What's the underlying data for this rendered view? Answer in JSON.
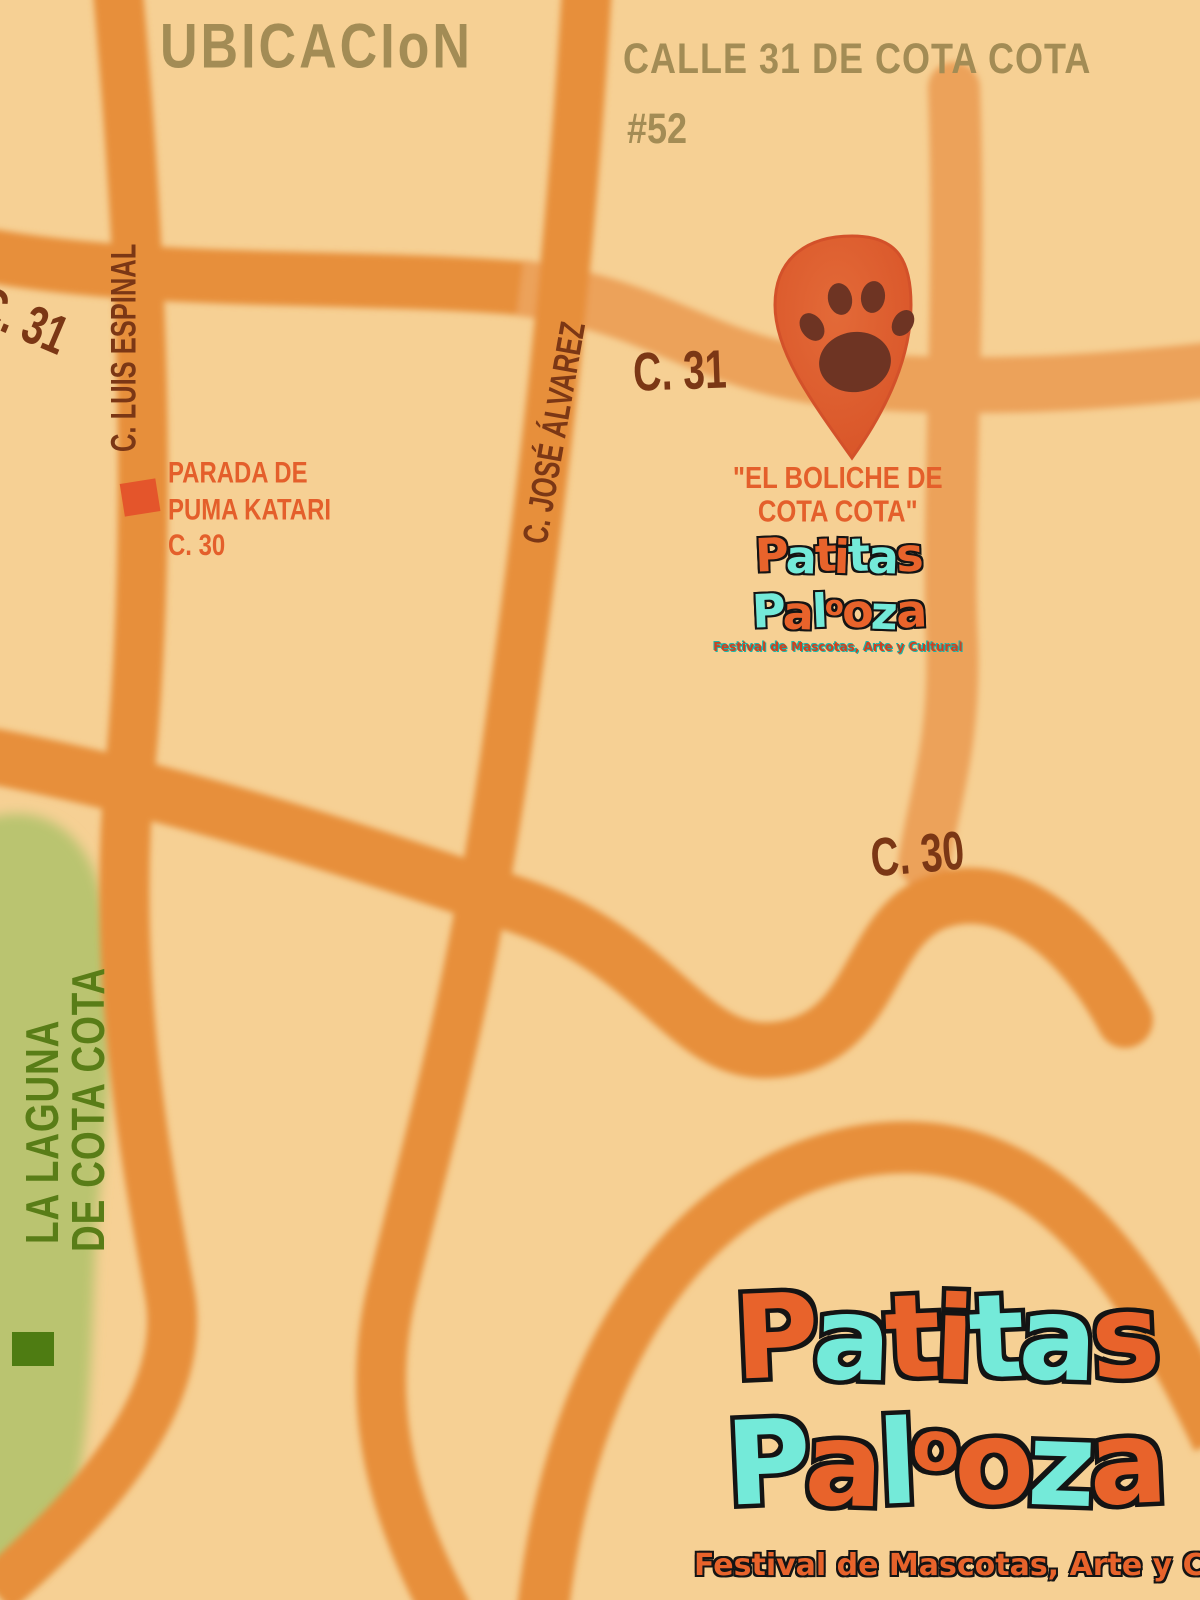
{
  "header": {
    "title": "UBICACIoN",
    "address_line1": "CALLE 31 DE COTA COTA",
    "address_line2": "#52"
  },
  "streets": {
    "c31_left": "C. 31",
    "c31_mid": "C. 31",
    "c30": "C. 30",
    "luis_espinal": "C. LUIS ESPINAL",
    "jose_alvarez": "C. JOSÉ ÁLVAREZ"
  },
  "bus_stop": {
    "line1": "PARADA DE",
    "line2": "PUMA KATARI",
    "line3": "C. 30"
  },
  "venue": {
    "line1": "\"EL BOLICHE DE",
    "line2": "COTA COTA\""
  },
  "laguna": {
    "line1": "LA LAGUNA",
    "line2": "DE COTA COTA"
  },
  "logo": {
    "word1": "Patitas",
    "word2": "Palooza",
    "word1_colors": [
      "orange",
      "teal",
      "orange",
      "orange",
      "teal",
      "teal",
      "orange"
    ],
    "word2_colors": [
      "teal",
      "orange",
      "teal",
      "orange",
      "orange",
      "teal",
      "orange"
    ],
    "subtitle": "Festival de Mascotas, Arte y Cultural",
    "orange": "#e8632b",
    "teal": "#74ead9",
    "outline": "#141414"
  },
  "colors": {
    "background": "#f6d094",
    "road": "#e78f3b",
    "road_light": "#eca25a",
    "label_dark": "#7b3715",
    "accent_orange": "#e45f2b",
    "title_olive": "#a38c55",
    "laguna_green": "#bac470",
    "laguna_text": "#597d17",
    "marker_green": "#4e7c12",
    "marker_red": "#e4552b",
    "pin": "#dd5a2e",
    "pin_dark": "#d3512a",
    "paw": "#6e3423"
  }
}
